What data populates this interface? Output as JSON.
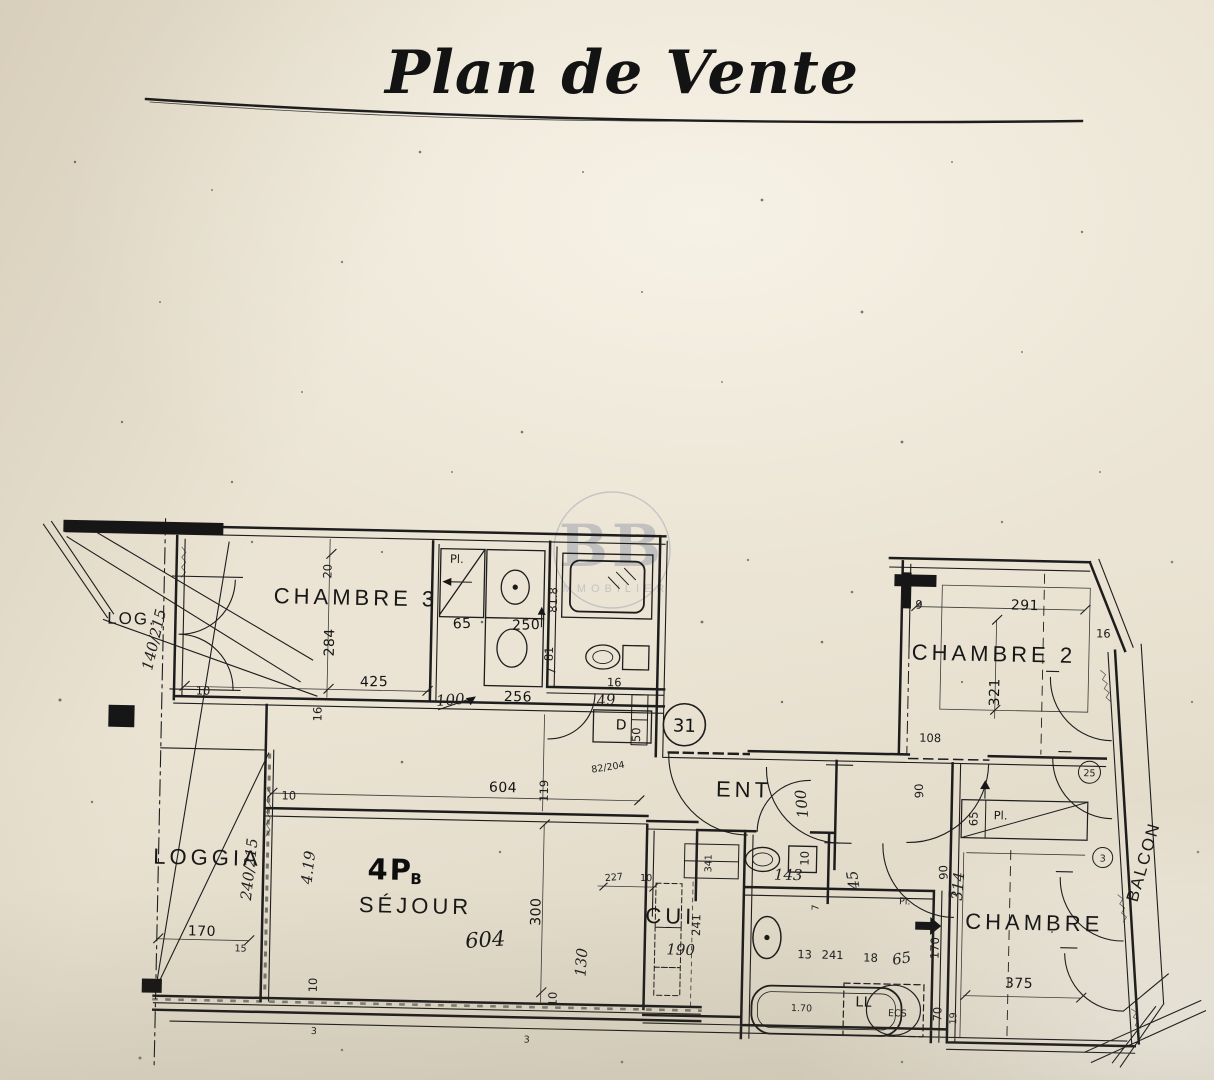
{
  "title": "Plan de Vente",
  "watermark": {
    "initials": "BB",
    "subtitle": "IMMOBILIER"
  },
  "rooms": {
    "log": "LOG.",
    "chambre3": "CHAMBRE 3",
    "chambre2": "CHAMBRE 2",
    "loggia": "LOGGIA",
    "unit_type": "4P",
    "unit_type_suffix": "B",
    "sejour": "SÉJOUR",
    "entrance": "ENT",
    "cuisine": "CUI",
    "chambre": "CHAMBRE",
    "balcon": "BALCON"
  },
  "lot_number": "31",
  "closets": {
    "pl1": "Pl.",
    "pl2": "Pl.",
    "pl3": "Pl."
  },
  "fixtures": {
    "cupboard": "D",
    "washer": "LL",
    "water_heater": "ECS",
    "tub_length": "1.70"
  },
  "wall_marks": {
    "c25": "25",
    "c3": "3"
  },
  "dims": {
    "d20": "20",
    "d284": "284",
    "d425": "425",
    "d16a": "16",
    "d10a": "10",
    "d100a": "100",
    "d140_215": "140/215",
    "d65a": "65",
    "d250": "250",
    "d81_8": "81.8",
    "d81": "81",
    "d7a": "7",
    "d256": "256",
    "d49": "49",
    "d16b": "16",
    "d50": "50",
    "d604a": "604",
    "d119": "119",
    "d82_204": "82/204",
    "d10b": "10",
    "d240_215": "240/215",
    "d4_19": "4.19",
    "d170a": "170",
    "d15": "15",
    "d10c": "10",
    "d604b": "604",
    "d300": "300",
    "d10d": "10",
    "d130": "130",
    "d3a": "3",
    "d3b": "3",
    "d227": "227",
    "d10e": "10",
    "d341": "341",
    "d241a": "241",
    "d190": "190",
    "d143": "143",
    "d100b": "100",
    "d10f": "10",
    "d45": "45",
    "d90a": "90",
    "d90b": "90",
    "d7b": "7",
    "d65b": "65",
    "d7c": "7",
    "d13": "13",
    "d241b": "241",
    "d18a": "18",
    "d65c": "65",
    "d70": "70",
    "d19": "19",
    "d170b": "170",
    "d314": "314",
    "d375": "375",
    "d9": "9",
    "d291": "291",
    "d321": "321",
    "d16c": "16",
    "d108": "108"
  }
}
